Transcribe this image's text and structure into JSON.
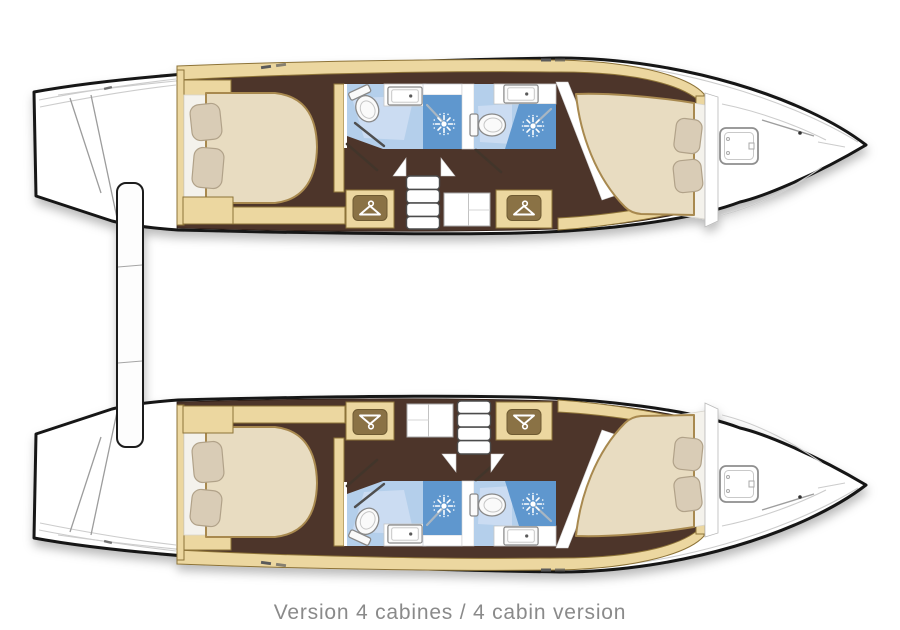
{
  "caption": "Version 4 cabines / 4 cabin version",
  "plan": {
    "type": "catamaran interior deck plan, top view",
    "layout": "4 cabin version",
    "hulls": [
      {
        "name": "port hull",
        "rooms": [
          "aft double cabin",
          "aft head with shower",
          "forward head with shower",
          "forward double cabin",
          "bow deck with hatch"
        ]
      },
      {
        "name": "starboard hull",
        "rooms": [
          "aft double cabin",
          "aft head with shower",
          "forward head with shower",
          "forward double cabin",
          "bow deck with hatch"
        ]
      }
    ],
    "fixtures_per_hull": {
      "double_berths": 2,
      "pillows": 4,
      "toilets": 2,
      "washbasins": 2,
      "showers": 2,
      "hanging_lockers": 2,
      "companionway_steps": 1,
      "deck_hatches": 1
    }
  },
  "icons": {
    "wardrobe": "clothes-hanger",
    "shower": "sunburst-shower-head",
    "toilet": "toilet-bowl",
    "sink": "washbasin-with-tap",
    "hatch": "deck-hatch-square"
  },
  "colors": {
    "background": "#ffffff",
    "hull_outline": "#161616",
    "hull_fill": "#ffffff",
    "deck_line": "#cccccc",
    "wood_light": "#ecd7a0",
    "wood_border": "#8d7337",
    "floor_brown": "#4d342a",
    "floor_edge": "#2e1f17",
    "mattress_cream": "#e8dcc1",
    "mattress_edge": "#a8894f",
    "pillow_beige": "#d9ccb6",
    "pillow_edge": "#b1a289",
    "sheet_white": "#f4f2ec",
    "bath_floor_blue": "#b4cfeb",
    "bath_floor_light": "#cbdcf2",
    "shower_blue": "#5e97ce",
    "fixture_white": "#fafafa",
    "fixture_edge": "#898989",
    "hanger_panel": "#8a7244",
    "step_edge": "#4c4c4c",
    "door_dark": "#43342a",
    "chrome": "#a9b6c2",
    "caption_gray": "#8a8a8a"
  }
}
